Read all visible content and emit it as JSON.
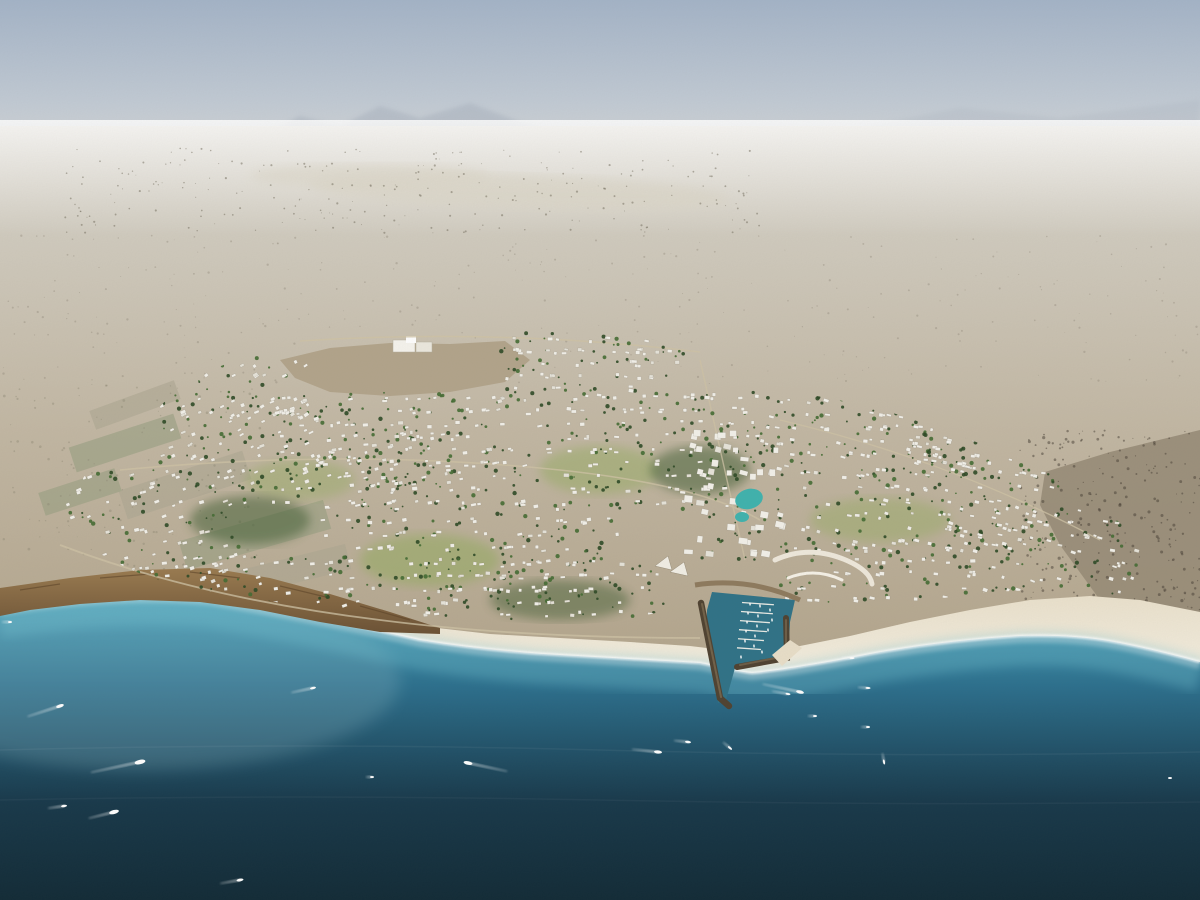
{
  "scene": {
    "description": "Aerial architectural rendering of a coastal desert master-planned community: hazy desert plain behind, green development filled with white villas in the middle, cliffs and white-sand beaches along the shore, a V-shaped marina with breakwaters and docked boats, and a turquoise-to-deep-blue sea with scattered boats and wakes in the foreground."
  },
  "palette": {
    "sky_top": "#a4b4c8",
    "sky_mid": "#c2cbd5",
    "sky_horizon": "#dad9d6",
    "mountain": "#a9b2bf",
    "desert_far": "#d1ccc0",
    "desert_mid": "#c2b7a3",
    "desert_near": "#b2a48b",
    "dry_lake": "#dcd7c9",
    "field_green": "#99a083",
    "field_tan": "#aea893",
    "rocky_desert": "#958a76",
    "dev_green_light": "#6f8d49",
    "dev_green": "#54713c",
    "dev_green_dark": "#3a5a2d",
    "lawn": "#8cab55",
    "tree_dark": "#2d4a26",
    "tree_mid": "#446b33",
    "villa_white": "#f3f1ea",
    "urban_white": "#e7e4da",
    "villa_shadow": "#9c9480",
    "cliff": "#9a7b50",
    "cliff_dark": "#6b5134",
    "beach": "#e9dfc9",
    "beach_bright": "#f4efe1",
    "sea_shelf": "#74c2d2",
    "sea_turquoise": "#47a3bd",
    "sea_mid": "#2b6f8d",
    "sea_deep": "#17384a",
    "sea_darkest": "#112a36",
    "marina_water": "#2f7287",
    "breakwater": "#4f4231",
    "breakwater_light": "#7a6a50",
    "promenade": "#8a7458",
    "lagoon": "#3fb3ae",
    "road": "#cfc3a6",
    "boat_white": "#ffffff"
  },
  "clusters": [
    {
      "x": 62,
      "y": 470,
      "w": 200,
      "h": 120,
      "count": 80,
      "angle": -18
    },
    {
      "x": 150,
      "y": 400,
      "w": 180,
      "h": 90,
      "count": 60,
      "angle": -25
    },
    {
      "x": 170,
      "y": 358,
      "w": 140,
      "h": 62,
      "count": 35,
      "angle": -30
    },
    {
      "x": 270,
      "y": 392,
      "w": 280,
      "h": 118,
      "count": 130,
      "angle": -8
    },
    {
      "x": 320,
      "y": 500,
      "w": 300,
      "h": 110,
      "count": 110,
      "angle": -5
    },
    {
      "x": 500,
      "y": 333,
      "w": 200,
      "h": 62,
      "count": 55,
      "angle": 5
    },
    {
      "x": 560,
      "y": 390,
      "w": 200,
      "h": 120,
      "count": 95,
      "angle": 0
    },
    {
      "x": 688,
      "y": 428,
      "w": 96,
      "h": 132,
      "count": 45,
      "angle": 8,
      "big": true
    },
    {
      "x": 760,
      "y": 395,
      "w": 220,
      "h": 80,
      "count": 85,
      "angle": 10
    },
    {
      "x": 800,
      "y": 468,
      "w": 260,
      "h": 82,
      "count": 90,
      "angle": 12
    },
    {
      "x": 948,
      "y": 503,
      "w": 200,
      "h": 96,
      "count": 60,
      "angle": 15
    },
    {
      "x": 780,
      "y": 543,
      "w": 200,
      "h": 62,
      "count": 45,
      "angle": 5
    },
    {
      "x": 60,
      "y": 558,
      "w": 300,
      "h": 52,
      "count": 35,
      "angle": -12
    },
    {
      "x": 420,
      "y": 558,
      "w": 250,
      "h": 62,
      "count": 50,
      "angle": 0
    },
    {
      "x": 905,
      "y": 418,
      "w": 120,
      "h": 62,
      "count": 30,
      "angle": 10
    },
    {
      "x": 340,
      "y": 428,
      "w": 120,
      "h": 62,
      "count": 40,
      "angle": -10
    }
  ],
  "speck_regions": [
    {
      "x": 60,
      "y": 148,
      "w": 700,
      "h": 85,
      "count": 260,
      "color": "#6f695a",
      "opacity": 0.5,
      "rmin": 0.4,
      "rmax": 1.1
    },
    {
      "x": 0,
      "y": 235,
      "w": 1200,
      "h": 150,
      "count": 320,
      "color": "#8a8272",
      "opacity": 0.35,
      "rmin": 0.4,
      "rmax": 1.2
    },
    {
      "x": 0,
      "y": 385,
      "w": 260,
      "h": 185,
      "count": 120,
      "color": "#8d8672",
      "opacity": 0.4,
      "rmin": 0.5,
      "rmax": 1.4
    },
    {
      "x": 1020,
      "y": 430,
      "w": 180,
      "h": 205,
      "count": 280,
      "color": "#453e33",
      "opacity": 0.5,
      "rmin": 0.5,
      "rmax": 1.6
    }
  ],
  "boats": [
    {
      "x": 60,
      "y": 706,
      "len": 8,
      "angle": -18,
      "wake": 34
    },
    {
      "x": 140,
      "y": 762,
      "len": 11,
      "angle": -12,
      "wake": 50
    },
    {
      "x": 64,
      "y": 806,
      "len": 6,
      "angle": -8,
      "wake": 16
    },
    {
      "x": 114,
      "y": 812,
      "len": 10,
      "angle": -14,
      "wake": 26
    },
    {
      "x": 240,
      "y": 880,
      "len": 7,
      "angle": -10,
      "wake": 20
    },
    {
      "x": 372,
      "y": 777,
      "len": 4,
      "angle": 0,
      "wake": 6
    },
    {
      "x": 468,
      "y": 763,
      "len": 9,
      "angle": -168,
      "wake": 40
    },
    {
      "x": 313,
      "y": 688,
      "len": 6,
      "angle": -12,
      "wake": 22
    },
    {
      "x": 658,
      "y": 752,
      "len": 8,
      "angle": 6,
      "wake": 26
    },
    {
      "x": 688,
      "y": 742,
      "len": 6,
      "angle": 6,
      "wake": 14
    },
    {
      "x": 800,
      "y": 692,
      "len": 8,
      "angle": 12,
      "wake": 38
    },
    {
      "x": 788,
      "y": 694,
      "len": 5,
      "angle": 10,
      "wake": 16
    },
    {
      "x": 852,
      "y": 658,
      "len": 5,
      "angle": 0,
      "wake": 10
    },
    {
      "x": 868,
      "y": 688,
      "len": 5,
      "angle": 4,
      "wake": 10
    },
    {
      "x": 815,
      "y": 716,
      "len": 4,
      "angle": 0,
      "wake": 7
    },
    {
      "x": 868,
      "y": 727,
      "len": 4,
      "angle": 0,
      "wake": 7
    },
    {
      "x": 884,
      "y": 762,
      "len": 5,
      "angle": 80,
      "wake": 9
    },
    {
      "x": 730,
      "y": 748,
      "len": 5,
      "angle": 40,
      "wake": 9
    },
    {
      "x": 1170,
      "y": 778,
      "len": 4,
      "angle": 0,
      "wake": 0
    },
    {
      "x": 10,
      "y": 622,
      "len": 4,
      "angle": 0,
      "wake": 8
    }
  ],
  "marina_boats": [
    {
      "x": 750,
      "y": 604
    },
    {
      "x": 760,
      "y": 606
    },
    {
      "x": 748,
      "y": 613
    },
    {
      "x": 758,
      "y": 616
    },
    {
      "x": 747,
      "y": 622
    },
    {
      "x": 757,
      "y": 626
    },
    {
      "x": 746,
      "y": 631
    },
    {
      "x": 755,
      "y": 636
    },
    {
      "x": 745,
      "y": 641
    },
    {
      "x": 754,
      "y": 646
    },
    {
      "x": 762,
      "y": 652
    },
    {
      "x": 741,
      "y": 657
    },
    {
      "x": 770,
      "y": 610
    },
    {
      "x": 772,
      "y": 620
    },
    {
      "x": 768,
      "y": 630
    }
  ]
}
